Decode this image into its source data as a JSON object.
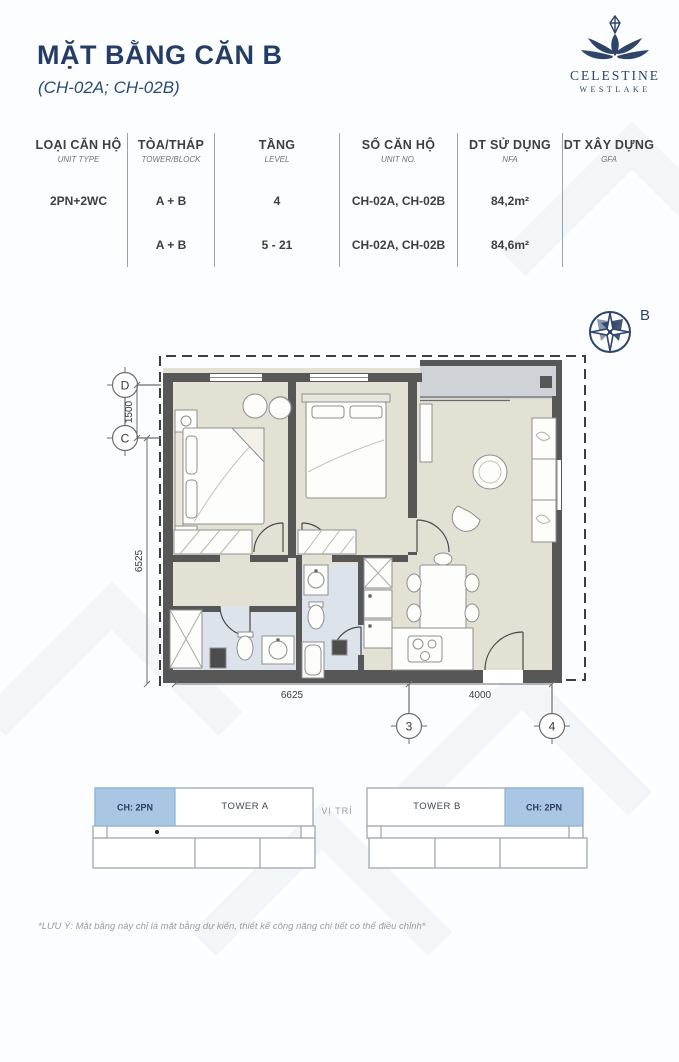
{
  "header": {
    "title": "MẶT BẰNG CĂN B",
    "subtitle": "(CH-02A; CH-02B)",
    "brand": {
      "name": "CELESTINE",
      "location": "WESTLAKE"
    }
  },
  "spec_table": {
    "columns": [
      {
        "vi": "LOẠI CĂN HỘ",
        "en": "UNIT TYPE"
      },
      {
        "vi": "TÒA/THÁP",
        "en": "TOWER/BLOCK"
      },
      {
        "vi": "TẦNG",
        "en": "LEVEL"
      },
      {
        "vi": "SỐ CĂN HỘ",
        "en": "UNIT NO."
      },
      {
        "vi": "DT SỬ DỤNG",
        "en": "NFA"
      },
      {
        "vi": "DT XÂY DỰNG",
        "en": "GFA"
      }
    ],
    "rows": [
      {
        "unit_type": "2PN+2WC",
        "tower": "A + B",
        "level": "4",
        "unit_no": "CH-02A, CH-02B",
        "nfa": "84,2m²",
        "gfa": ""
      },
      {
        "unit_type": "",
        "tower": "A + B",
        "level": "5 - 21",
        "unit_no": "CH-02A, CH-02B",
        "nfa": "84,6m²",
        "gfa": ""
      }
    ]
  },
  "floor_plan": {
    "compass_label": "B",
    "grid_labels": {
      "row_d": "D",
      "row_c": "C",
      "col_3": "3",
      "col_4": "4"
    },
    "dimensions": {
      "dc_spacing": "1500",
      "left_height": "6525",
      "bottom_left_width": "6625",
      "bottom_right_width": "4000"
    }
  },
  "location_diagram": {
    "section_label": "VỊ TRÍ",
    "towers": [
      {
        "name": "TOWER A",
        "highlight_unit": "CH: 2PN"
      },
      {
        "name": "TOWER B",
        "highlight_unit": "CH: 2PN"
      }
    ]
  },
  "footer": {
    "note": "*LƯU Ý: Mặt bằng này chỉ là mặt bằng dự kiến, thiết kế công năng chi tiết có thể điều chỉnh*"
  },
  "colors": {
    "navy": "#2e4469",
    "highlight_blue": "#a9c6e2",
    "floor_beige": "#e3e0d4",
    "floor_bath_blue": "#dde3eb",
    "balcony_grey": "#cfd3d8",
    "wall_grey": "#575757"
  }
}
